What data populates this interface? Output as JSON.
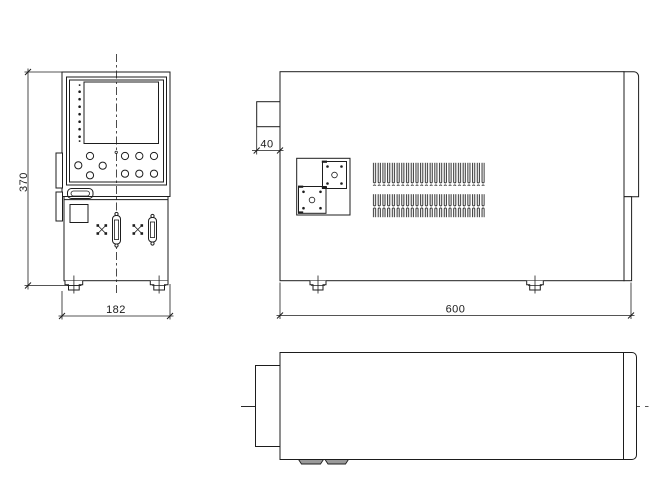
{
  "title": "VTA-20KC(MASTER)",
  "dimensions": {
    "front_height_mm": "370",
    "front_width_mm": "182",
    "side_depth_mm": "600",
    "rear_protrusion_mm": "40"
  },
  "colors": {
    "line": "#1d1d1d",
    "background": "#ffffff"
  }
}
